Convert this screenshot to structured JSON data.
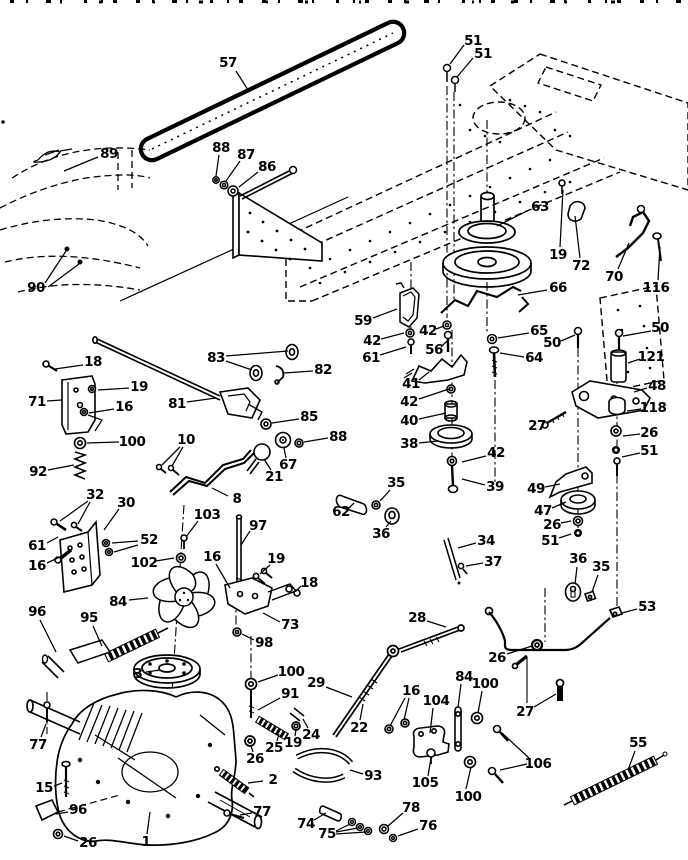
{
  "canvas": {
    "width": 688,
    "height": 860,
    "paper_color": "#ffffff",
    "ink_color": "#000000"
  },
  "callouts": [
    {
      "label": "57",
      "x": 228,
      "y": 63,
      "leaders": [
        [
          236,
          71,
          248,
          90
        ]
      ]
    },
    {
      "label": "51",
      "x": 473,
      "y": 41,
      "leaders": [
        [
          464,
          45,
          450,
          64
        ]
      ]
    },
    {
      "label": "51",
      "x": 483,
      "y": 54,
      "leaders": [
        [
          473,
          58,
          457,
          77
        ]
      ]
    },
    {
      "label": "89",
      "x": 109,
      "y": 154,
      "leaders": [
        [
          98,
          157,
          64,
          171
        ]
      ]
    },
    {
      "label": "90",
      "x": 36,
      "y": 288,
      "leaders": [
        [
          45,
          283,
          66,
          251
        ],
        [
          48,
          287,
          79,
          264
        ]
      ]
    },
    {
      "label": "88",
      "x": 221,
      "y": 148,
      "leaders": [
        [
          219,
          155,
          216,
          176
        ]
      ]
    },
    {
      "label": "87",
      "x": 246,
      "y": 155,
      "leaders": [
        [
          240,
          161,
          226,
          181
        ]
      ]
    },
    {
      "label": "86",
      "x": 267,
      "y": 167,
      "leaders": [
        [
          258,
          172,
          239,
          187
        ]
      ]
    },
    {
      "label": "63",
      "x": 540,
      "y": 207,
      "leaders": [
        [
          529,
          210,
          497,
          226
        ]
      ]
    },
    {
      "label": "19",
      "x": 558,
      "y": 255,
      "leaders": [
        [
          560,
          247,
          563,
          190
        ]
      ]
    },
    {
      "label": "72",
      "x": 581,
      "y": 266,
      "leaders": [
        [
          580,
          258,
          575,
          216
        ]
      ]
    },
    {
      "label": "70",
      "x": 614,
      "y": 277,
      "leaders": [
        [
          618,
          269,
          629,
          243
        ]
      ]
    },
    {
      "label": "116",
      "x": 656,
      "y": 288,
      "leaders": [
        [
          658,
          280,
          660,
          247
        ]
      ]
    },
    {
      "label": "66",
      "x": 558,
      "y": 288,
      "leaders": [
        [
          547,
          290,
          518,
          295
        ]
      ]
    },
    {
      "label": "59",
      "x": 363,
      "y": 321,
      "leaders": [
        [
          373,
          318,
          397,
          309
        ]
      ]
    },
    {
      "label": "42",
      "x": 372,
      "y": 341,
      "leaders": [
        [
          381,
          339,
          404,
          333
        ]
      ]
    },
    {
      "label": "61",
      "x": 371,
      "y": 358,
      "leaders": [
        [
          380,
          355,
          406,
          347
        ]
      ]
    },
    {
      "label": "42",
      "x": 428,
      "y": 331,
      "leaders": [
        [
          436,
          329,
          444,
          326
        ]
      ]
    },
    {
      "label": "56",
      "x": 434,
      "y": 350,
      "leaders": [
        [
          441,
          347,
          447,
          341
        ]
      ]
    },
    {
      "label": "65",
      "x": 539,
      "y": 331,
      "leaders": [
        [
          529,
          333,
          498,
          338
        ]
      ]
    },
    {
      "label": "50",
      "x": 552,
      "y": 343,
      "leaders": [
        [
          561,
          341,
          575,
          335
        ]
      ]
    },
    {
      "label": "50",
      "x": 660,
      "y": 328,
      "leaders": [
        [
          651,
          331,
          623,
          336
        ]
      ]
    },
    {
      "label": "64",
      "x": 534,
      "y": 358,
      "leaders": [
        [
          524,
          357,
          500,
          353
        ]
      ]
    },
    {
      "label": "121",
      "x": 651,
      "y": 357,
      "leaders": [
        [
          640,
          359,
          628,
          363
        ]
      ]
    },
    {
      "label": "41",
      "x": 411,
      "y": 384,
      "leaders": [
        [
          419,
          380,
          429,
          372
        ]
      ]
    },
    {
      "label": "42",
      "x": 409,
      "y": 402,
      "leaders": [
        [
          419,
          399,
          449,
          389
        ]
      ]
    },
    {
      "label": "48",
      "x": 657,
      "y": 386,
      "leaders": [
        [
          647,
          388,
          634,
          392
        ]
      ]
    },
    {
      "label": "40",
      "x": 409,
      "y": 421,
      "leaders": [
        [
          419,
          419,
          446,
          413
        ]
      ]
    },
    {
      "label": "27",
      "x": 537,
      "y": 426,
      "leaders": [
        [
          546,
          423,
          556,
          418
        ]
      ]
    },
    {
      "label": "118",
      "x": 653,
      "y": 408,
      "leaders": [
        [
          641,
          409,
          627,
          411
        ]
      ]
    },
    {
      "label": "38",
      "x": 409,
      "y": 444,
      "leaders": [
        [
          419,
          443,
          438,
          441
        ]
      ]
    },
    {
      "label": "26",
      "x": 649,
      "y": 433,
      "leaders": [
        [
          640,
          434,
          623,
          436
        ]
      ]
    },
    {
      "label": "42",
      "x": 496,
      "y": 453,
      "leaders": [
        [
          486,
          456,
          462,
          462
        ]
      ]
    },
    {
      "label": "51",
      "x": 649,
      "y": 451,
      "leaders": [
        [
          640,
          453,
          622,
          457
        ]
      ]
    },
    {
      "label": "39",
      "x": 495,
      "y": 487,
      "leaders": [
        [
          485,
          485,
          462,
          479
        ]
      ]
    },
    {
      "label": "49",
      "x": 536,
      "y": 489,
      "leaders": [
        [
          545,
          487,
          560,
          484
        ]
      ]
    },
    {
      "label": "47",
      "x": 543,
      "y": 511,
      "leaders": [
        [
          552,
          508,
          566,
          502
        ]
      ]
    },
    {
      "label": "26",
      "x": 552,
      "y": 525,
      "leaders": [
        [
          561,
          523,
          571,
          521
        ]
      ]
    },
    {
      "label": "51",
      "x": 550,
      "y": 541,
      "leaders": [
        [
          559,
          538,
          571,
          534
        ]
      ]
    },
    {
      "label": "34",
      "x": 486,
      "y": 541,
      "leaders": [
        [
          476,
          543,
          458,
          548
        ]
      ]
    },
    {
      "label": "37",
      "x": 493,
      "y": 562,
      "leaders": [
        [
          483,
          563,
          466,
          566
        ]
      ]
    },
    {
      "label": "36",
      "x": 578,
      "y": 559,
      "leaders": [
        [
          577,
          567,
          575,
          584
        ]
      ]
    },
    {
      "label": "35",
      "x": 601,
      "y": 567,
      "leaders": [
        [
          598,
          575,
          592,
          592
        ]
      ]
    },
    {
      "label": "18",
      "x": 93,
      "y": 362,
      "leaders": [
        [
          83,
          365,
          55,
          369
        ]
      ]
    },
    {
      "label": "19",
      "x": 139,
      "y": 387,
      "leaders": [
        [
          129,
          388,
          98,
          390
        ]
      ]
    },
    {
      "label": "71",
      "x": 37,
      "y": 402,
      "leaders": [
        [
          47,
          401,
          62,
          400
        ]
      ]
    },
    {
      "label": "16",
      "x": 124,
      "y": 407,
      "leaders": [
        [
          114,
          409,
          89,
          413
        ]
      ]
    },
    {
      "label": "100",
      "x": 132,
      "y": 442,
      "leaders": [
        [
          119,
          442,
          87,
          443
        ]
      ]
    },
    {
      "label": "92",
      "x": 38,
      "y": 472,
      "leaders": [
        [
          48,
          470,
          74,
          465
        ]
      ]
    },
    {
      "label": "83",
      "x": 216,
      "y": 358,
      "leaders": [
        [
          226,
          361,
          252,
          370
        ],
        [
          226,
          356,
          288,
          351
        ]
      ]
    },
    {
      "label": "82",
      "x": 323,
      "y": 370,
      "leaders": [
        [
          313,
          371,
          284,
          373
        ]
      ]
    },
    {
      "label": "81",
      "x": 177,
      "y": 404,
      "leaders": [
        [
          187,
          402,
          216,
          398
        ]
      ]
    },
    {
      "label": "85",
      "x": 309,
      "y": 417,
      "leaders": [
        [
          299,
          419,
          272,
          423
        ]
      ]
    },
    {
      "label": "88",
      "x": 338,
      "y": 437,
      "leaders": [
        [
          328,
          438,
          304,
          442
        ]
      ]
    },
    {
      "label": "10",
      "x": 186,
      "y": 440,
      "leaders": [
        [
          180,
          447,
          162,
          465
        ],
        [
          183,
          447,
          172,
          466
        ]
      ]
    },
    {
      "label": "21",
      "x": 274,
      "y": 477,
      "leaders": [
        [
          271,
          470,
          264,
          459
        ]
      ]
    },
    {
      "label": "67",
      "x": 288,
      "y": 465,
      "leaders": [
        [
          286,
          458,
          284,
          448
        ]
      ]
    },
    {
      "label": "8",
      "x": 237,
      "y": 499,
      "leaders": [
        [
          228,
          496,
          212,
          488
        ]
      ]
    },
    {
      "label": "62",
      "x": 341,
      "y": 512,
      "leaders": [
        [
          349,
          508,
          354,
          503
        ]
      ]
    },
    {
      "label": "35",
      "x": 396,
      "y": 483,
      "leaders": [
        [
          390,
          490,
          380,
          501
        ]
      ]
    },
    {
      "label": "36",
      "x": 381,
      "y": 534,
      "leaders": [
        [
          386,
          527,
          391,
          521
        ]
      ]
    },
    {
      "label": "52",
      "x": 149,
      "y": 540,
      "leaders": [
        [
          138,
          541,
          112,
          543
        ],
        [
          138,
          545,
          114,
          552
        ]
      ]
    },
    {
      "label": "32",
      "x": 95,
      "y": 495,
      "leaders": [
        [
          88,
          501,
          60,
          521
        ],
        [
          90,
          502,
          78,
          524
        ]
      ]
    },
    {
      "label": "30",
      "x": 126,
      "y": 503,
      "leaders": [
        [
          119,
          509,
          104,
          530
        ]
      ]
    },
    {
      "label": "61",
      "x": 37,
      "y": 546,
      "leaders": [
        [
          47,
          543,
          58,
          537
        ]
      ]
    },
    {
      "label": "16",
      "x": 37,
      "y": 566,
      "leaders": [
        [
          47,
          563,
          62,
          556
        ]
      ]
    },
    {
      "label": "103",
      "x": 207,
      "y": 515,
      "leaders": [
        [
          198,
          521,
          186,
          537
        ]
      ]
    },
    {
      "label": "102",
      "x": 144,
      "y": 563,
      "leaders": [
        [
          156,
          561,
          174,
          558
        ]
      ]
    },
    {
      "label": "97",
      "x": 258,
      "y": 526,
      "leaders": [
        [
          250,
          531,
          241,
          545
        ]
      ]
    },
    {
      "label": "16",
      "x": 212,
      "y": 557,
      "leaders": [
        [
          216,
          564,
          230,
          588
        ]
      ]
    },
    {
      "label": "19",
      "x": 276,
      "y": 559,
      "leaders": [
        [
          270,
          565,
          260,
          574
        ]
      ]
    },
    {
      "label": "18",
      "x": 309,
      "y": 583,
      "leaders": [
        [
          301,
          586,
          297,
          590
        ]
      ]
    },
    {
      "label": "84",
      "x": 118,
      "y": 602,
      "leaders": [
        [
          129,
          600,
          148,
          598
        ]
      ]
    },
    {
      "label": "73",
      "x": 290,
      "y": 625,
      "leaders": [
        [
          280,
          622,
          263,
          613
        ]
      ]
    },
    {
      "label": "96",
      "x": 37,
      "y": 612,
      "leaders": [
        [
          40,
          620,
          56,
          652
        ]
      ]
    },
    {
      "label": "95",
      "x": 89,
      "y": 618,
      "leaders": [
        [
          93,
          626,
          102,
          646
        ]
      ]
    },
    {
      "label": "98",
      "x": 264,
      "y": 643,
      "leaders": [
        [
          254,
          640,
          242,
          634
        ]
      ]
    },
    {
      "label": "28",
      "x": 417,
      "y": 618,
      "leaders": [
        [
          427,
          621,
          446,
          627
        ]
      ]
    },
    {
      "label": "53",
      "x": 647,
      "y": 607,
      "leaders": [
        [
          637,
          609,
          622,
          613
        ]
      ]
    },
    {
      "label": "26",
      "x": 497,
      "y": 658,
      "leaders": [
        [
          507,
          654,
          532,
          646
        ]
      ]
    },
    {
      "label": "27",
      "x": 525,
      "y": 712,
      "leaders": [
        [
          534,
          707,
          556,
          694
        ]
      ]
    },
    {
      "label": "3",
      "x": 138,
      "y": 674,
      "leaders": [
        [
          146,
          672,
          160,
          670
        ]
      ]
    },
    {
      "label": "100",
      "x": 291,
      "y": 672,
      "leaders": [
        [
          278,
          675,
          258,
          682
        ]
      ]
    },
    {
      "label": "29",
      "x": 316,
      "y": 683,
      "leaders": [
        [
          326,
          687,
          352,
          697
        ]
      ]
    },
    {
      "label": "91",
      "x": 290,
      "y": 694,
      "leaders": [
        [
          280,
          698,
          258,
          710
        ]
      ]
    },
    {
      "label": "24",
      "x": 311,
      "y": 735,
      "leaders": [
        [
          308,
          728,
          303,
          719
        ]
      ]
    },
    {
      "label": "19",
      "x": 293,
      "y": 743,
      "leaders": [
        [
          295,
          736,
          296,
          730
        ]
      ]
    },
    {
      "label": "25",
      "x": 274,
      "y": 748,
      "leaders": [
        [
          277,
          741,
          279,
          734
        ]
      ]
    },
    {
      "label": "26",
      "x": 255,
      "y": 759,
      "leaders": [
        [
          253,
          752,
          251,
          746
        ]
      ]
    },
    {
      "label": "2",
      "x": 273,
      "y": 780,
      "leaders": [
        [
          263,
          781,
          248,
          783
        ]
      ]
    },
    {
      "label": "77",
      "x": 38,
      "y": 745,
      "leaders": [
        [
          41,
          737,
          46,
          724
        ]
      ]
    },
    {
      "label": "15",
      "x": 44,
      "y": 788,
      "leaders": [
        [
          54,
          786,
          62,
          783
        ]
      ]
    },
    {
      "label": "96",
      "x": 78,
      "y": 810,
      "leaders": [
        [
          68,
          812,
          56,
          814
        ]
      ]
    },
    {
      "label": "26",
      "x": 88,
      "y": 843,
      "leaders": [
        [
          78,
          841,
          64,
          836
        ]
      ]
    },
    {
      "label": "1",
      "x": 146,
      "y": 842,
      "leaders": [
        [
          147,
          834,
          150,
          812
        ]
      ]
    },
    {
      "label": "77",
      "x": 262,
      "y": 812,
      "leaders": [
        [
          252,
          813,
          240,
          815
        ]
      ]
    },
    {
      "label": "74",
      "x": 306,
      "y": 824,
      "leaders": [
        [
          314,
          820,
          326,
          813
        ]
      ]
    },
    {
      "label": "75",
      "x": 327,
      "y": 834,
      "leaders": [
        [
          336,
          831,
          350,
          824
        ],
        [
          336,
          832,
          358,
          828
        ],
        [
          336,
          834,
          366,
          832
        ]
      ]
    },
    {
      "label": "78",
      "x": 411,
      "y": 808,
      "leaders": [
        [
          403,
          813,
          388,
          826
        ]
      ]
    },
    {
      "label": "76",
      "x": 428,
      "y": 826,
      "leaders": [
        [
          418,
          829,
          398,
          836
        ]
      ]
    },
    {
      "label": "93",
      "x": 373,
      "y": 776,
      "leaders": [
        [
          363,
          774,
          350,
          770
        ]
      ]
    },
    {
      "label": "22",
      "x": 359,
      "y": 728,
      "leaders": [
        [
          360,
          720,
          363,
          704
        ]
      ]
    },
    {
      "label": "16",
      "x": 411,
      "y": 691,
      "leaders": [
        [
          405,
          698,
          390,
          726
        ],
        [
          409,
          698,
          404,
          720
        ]
      ]
    },
    {
      "label": "104",
      "x": 436,
      "y": 701,
      "leaders": [
        [
          433,
          708,
          430,
          733
        ]
      ]
    },
    {
      "label": "84",
      "x": 464,
      "y": 677,
      "leaders": [
        [
          461,
          684,
          458,
          707
        ]
      ]
    },
    {
      "label": "100",
      "x": 485,
      "y": 684,
      "leaders": [
        [
          482,
          691,
          478,
          713
        ]
      ]
    },
    {
      "label": "106",
      "x": 538,
      "y": 764,
      "leaders": [
        [
          529,
          758,
          502,
          733
        ],
        [
          527,
          764,
          500,
          770
        ]
      ]
    },
    {
      "label": "105",
      "x": 425,
      "y": 783,
      "leaders": [
        [
          428,
          776,
          431,
          758
        ]
      ]
    },
    {
      "label": "100",
      "x": 468,
      "y": 797,
      "leaders": [
        [
          466,
          789,
          471,
          767
        ]
      ]
    },
    {
      "label": "55",
      "x": 638,
      "y": 743,
      "leaders": [
        [
          635,
          751,
          628,
          770
        ]
      ]
    }
  ]
}
